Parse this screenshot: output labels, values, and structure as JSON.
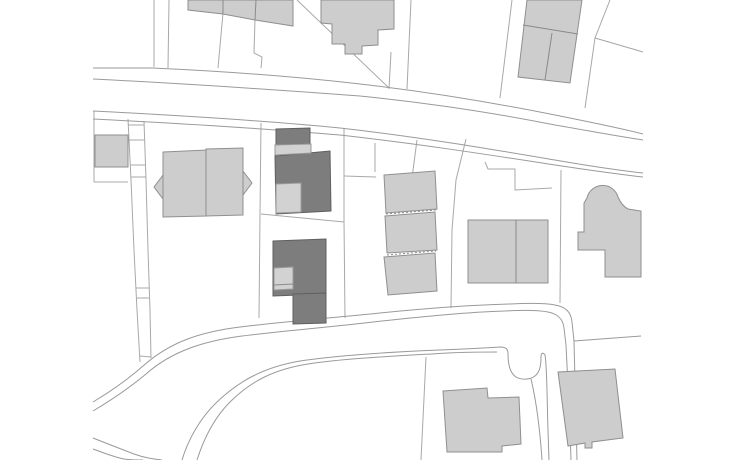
{
  "canvas": {
    "width": 736,
    "height": 460,
    "background": "#ffffff"
  },
  "palette": {
    "background": "#ffffff",
    "parcel_line": "#a8a8a8",
    "road_line": "#9a9a9a",
    "building_light_fill": "#cdcdcd",
    "building_light_stroke": "#8f8f8f",
    "building_dark_fill": "#7d7d7d",
    "building_dark_stroke": "#5f5f5f",
    "building_accent_fill": "#d2d2d2",
    "building_accent_stroke": "#9a9a9a",
    "interior_line": "#8a8a8a"
  },
  "parcel_lines": [
    {
      "name": "parcel-line-top-1",
      "points": "154,0 154,67"
    },
    {
      "name": "parcel-line-top-2",
      "points": "169,0 168,68"
    },
    {
      "name": "parcel-line-top-3",
      "points": "223,13 218,68"
    },
    {
      "name": "parcel-line-top-4",
      "points": "255,19 254,53 262,57 261,68"
    },
    {
      "name": "parcel-line-top-diagonal",
      "points": "297,0 389,88"
    },
    {
      "name": "parcel-line-top-5",
      "points": "391,52 389,89"
    },
    {
      "name": "parcel-line-top-6",
      "points": "411,0 407,89"
    },
    {
      "name": "parcel-line-top-7",
      "points": "512,0 500,98"
    },
    {
      "name": "parcel-line-top-8",
      "points": "610,0 595,38 585,108"
    },
    {
      "name": "parcel-line-top-9-diagonal-east",
      "points": "595,38 643,52"
    },
    {
      "name": "parcel-line-left-vertical",
      "points": "94,111 94,182"
    },
    {
      "name": "parcel-line-left-horizontal",
      "points": "94,182 128,182"
    },
    {
      "name": "parcel-line-house-right",
      "points": "261,123 260,215 259,318"
    },
    {
      "name": "parcel-line-dark-division",
      "points": "261,214 344,222"
    },
    {
      "name": "parcel-line-dark-right",
      "points": "344,128 344,220 345,318"
    },
    {
      "name": "parcel-line-mid-tie",
      "points": "344,176 376,177"
    },
    {
      "name": "parcel-line-mid-short",
      "points": "375,143 375,172"
    },
    {
      "name": "parcel-line-mid-slant",
      "points": "417,140 412,178"
    },
    {
      "name": "parcel-line-slabs-right",
      "points": "466,139 456,180 452,230 451,308"
    },
    {
      "name": "parcel-line-step-east",
      "points": "485,162 488,169 515,169 515,190 552,188"
    },
    {
      "name": "parcel-line-east-vertical",
      "points": "561,170 560,303"
    },
    {
      "name": "parcel-line-bottom-center",
      "points": "426,357 421,460"
    },
    {
      "name": "driveway-strip-left",
      "points": "128,119 131,180 134,250 137,310 140,362"
    },
    {
      "name": "driveway-strip-right",
      "points": "144,121 146,180 148,250 150,310 151,358"
    },
    {
      "name": "driveway-strip-tie-1",
      "points": "128,125 144,125"
    },
    {
      "name": "driveway-strip-tie-2",
      "points": "129,140 145,140"
    },
    {
      "name": "driveway-strip-tie-3",
      "points": "130,165 145,165"
    },
    {
      "name": "driveway-strip-tie-4",
      "points": "131,177 146,177"
    },
    {
      "name": "driveway-strip-tie-5",
      "points": "136,288 149,288"
    },
    {
      "name": "driveway-strip-tie-6",
      "points": "137,298 149,298"
    },
    {
      "name": "driveway-strip-tie-7",
      "points": "140,356 151,357"
    }
  ],
  "road_lines": [
    {
      "name": "upper-road-parcel-front-north",
      "d": "M93,68 L152,68 C240,72 300,77 360,84 C430,92 500,104 555,115 C590,122 620,128 643,134"
    },
    {
      "name": "upper-road-edge-north",
      "d": "M93,79 C190,84 280,90 360,96 C430,103 500,114 555,125 C590,131 622,137 643,140"
    },
    {
      "name": "upper-road-edge-south",
      "d": "M93,111 C190,116 270,121 340,128 C420,137 490,149 555,160 C595,167 625,171 643,173"
    },
    {
      "name": "upper-road-parcel-front-south",
      "d": "M93,119 C190,124 270,129 340,135 C420,144 490,155 555,165 C595,171 625,175 643,177"
    },
    {
      "name": "lower-road-parcel-front-north",
      "d": "M93,402 C108,393 126,381 143,366 C170,342 200,332 240,327 C280,322 330,318 380,313 C420,309 470,305 510,304 C530,303 545,303 555,305 C566,307 571,312 572,322 L574,341 C575,380 576,420 577,460"
    },
    {
      "name": "lower-road-edge-north",
      "d": "M93,411 C110,401 128,389 146,374 C172,351 204,341 242,336 C282,331 332,327 382,321 C420,317 468,312 505,311 C522,310 538,310 548,312 C558,314 563,319 564,328 L566,345 C568,385 570,425 571,460"
    },
    {
      "name": "lower-road-edge-south-with-stub",
      "d": "M182,460 C188,440 200,418 217,402 C240,380 265,367 300,361 C340,355 390,352 440,350 C465,349 485,348 500,347 C506,347 508,349 508,354 C508,365 510,373 516,377 C521,380 530,380 535,376 C540,372 541,365 541,357 C541,353 543,352 545,355 C547,365 547,400 548,430 L549,460"
    },
    {
      "name": "lower-road-parcel-front-south",
      "d": "M197,460 C204,438 214,418 230,402 C252,380 276,369 308,364 C348,358 398,356 448,353 C468,352 484,352 497,352"
    },
    {
      "name": "branch-road-parcel-line-west",
      "d": "M531,379 C536,400 540,430 542,460"
    },
    {
      "name": "southwest-road-edge",
      "d": "M93,438 C108,444 121,449 134,454 C145,458 154,459 162,460"
    },
    {
      "name": "southwest-road-parcel-front",
      "d": "M93,449 C104,453 114,457 124,459 C130,460 136,460 143,460"
    },
    {
      "name": "east-parcel-front-line",
      "d": "M574,341 L641,336"
    }
  ],
  "buildings_light": [
    {
      "name": "building-top-left-row",
      "points": "188,0 293,0 293,26 255,20 223,14 188,10"
    },
    {
      "name": "building-top-stepped",
      "points": "321,0 394,0 394,29 378,30 378,45 362,46 362,54 345,54 345,44 332,44 332,24 321,23"
    },
    {
      "name": "building-top-right-pair",
      "points": "527,0 582,0 570,83 518,77"
    },
    {
      "name": "building-west-small",
      "points": "95,135 128,135 128,167 95,167"
    },
    {
      "name": "building-house-wing-left",
      "points": "163,152 207,150 207,216 163,217"
    },
    {
      "name": "building-house-wing-right",
      "points": "206,149 243,148 243,215 206,216"
    },
    {
      "name": "building-house-gable-left",
      "points": "163,175 154,187 163,199"
    },
    {
      "name": "building-house-gable-right",
      "points": "243,171 252,183 243,195"
    },
    {
      "name": "building-slab-1",
      "points": "384,175 435,171 437,209 386,213"
    },
    {
      "name": "building-slab-2",
      "points": "385,216 435,212 437,250 387,253"
    },
    {
      "name": "building-slab-3",
      "points": "384,257 435,253 437,291 388,295"
    },
    {
      "name": "building-east-rect",
      "points": "468,220 548,220 548,283 468,283"
    },
    {
      "name": "building-bottom-center",
      "points": "443,391 487,388 488,398 519,397 521,444 502,446 502,452 447,452"
    },
    {
      "name": "building-bottom-right",
      "points": "558,372 615,369 623,438 592,442 592,448 585,448 585,443 568,446"
    }
  ],
  "buildings_light_paths": [
    {
      "name": "building-east-keyhole",
      "d": "M578,250 L578,232 L584,232 L584,203 L587,198 A16,16 0 0 1 618,197 Q622,206 628,209 L641,211 L641,277 L605,277 L605,250 Z"
    }
  ],
  "buildings_dark": [
    {
      "name": "project-building-north-top",
      "points": "276,129 310,128 310,144 276,145"
    },
    {
      "name": "project-building-north-main",
      "points": "275,156 330,151 331,211 276,214"
    },
    {
      "name": "project-building-south-main",
      "points": "273,241 326,239 326,294 273,296"
    },
    {
      "name": "project-building-south-lower",
      "points": "293,294 326,293 326,323 293,324"
    }
  ],
  "buildings_accent": [
    {
      "name": "project-building-north-band",
      "points": "275,145 311,144 311,153 275,155"
    },
    {
      "name": "project-building-north-notch",
      "points": "276,184 301,183 301,212 276,213"
    },
    {
      "name": "project-building-south-notch",
      "points": "274,268 293,267 293,289 274,290"
    }
  ],
  "interior_lines": [
    {
      "name": "building-top-left-division-1",
      "points": "223,0 223,14",
      "dashed": false
    },
    {
      "name": "building-top-left-division-2",
      "points": "256,0 255,20",
      "dashed": false
    },
    {
      "name": "building-top-right-division-h",
      "points": "523,25 578,34",
      "dashed": false
    },
    {
      "name": "building-top-right-division-v",
      "points": "552,33 545,80",
      "dashed": false
    },
    {
      "name": "building-east-rect-division",
      "points": "516,220 516,283",
      "dashed": false
    },
    {
      "name": "building-slab-gap-1",
      "points": "386,214 436,210",
      "dashed": true
    },
    {
      "name": "building-slab-gap-2",
      "points": "387,255 436,251",
      "dashed": true
    },
    {
      "name": "project-building-south-notch-division",
      "points": "274,285 293,284",
      "dashed": false
    }
  ]
}
